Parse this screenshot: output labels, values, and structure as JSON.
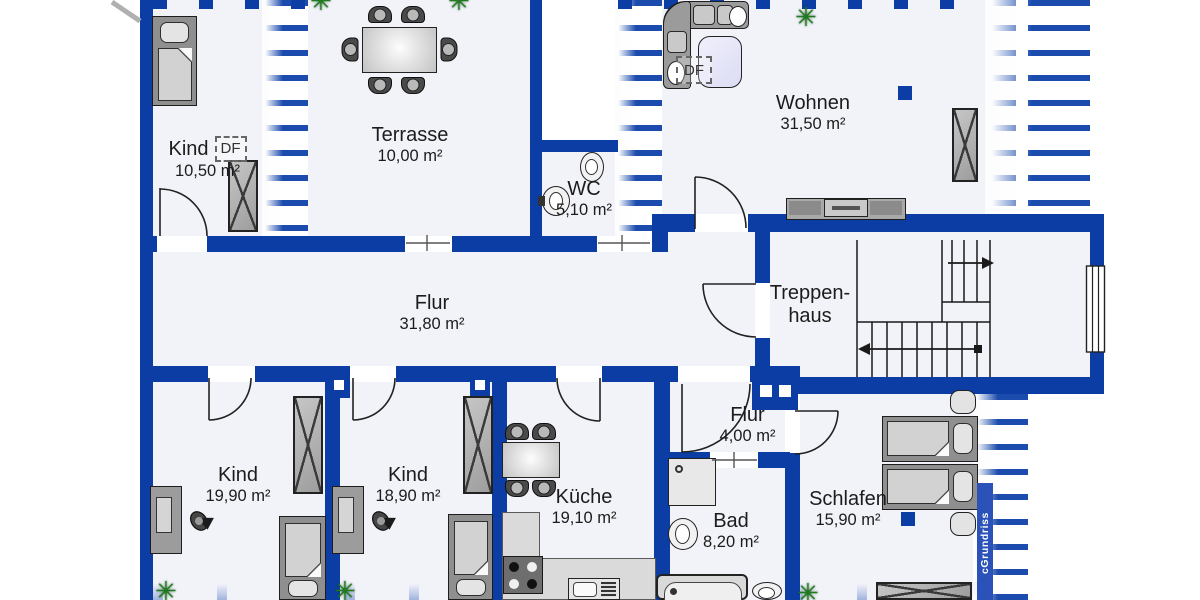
{
  "colors": {
    "wall": "#0c3da5",
    "hatch": "#1b4bad",
    "floor": "#f1f3f8",
    "green": "#1e7a1e",
    "rug": "#dcdcf4",
    "wmbg": "#2a52b8"
  },
  "rooms": [
    {
      "id": "kind-og",
      "name": "Kind",
      "area": "10,50 m²"
    },
    {
      "id": "terrasse",
      "name": "Terrasse",
      "area": "10,00 m²"
    },
    {
      "id": "wc",
      "name": "WC",
      "area": "5,10 m²"
    },
    {
      "id": "wohnen",
      "name": "Wohnen",
      "area": "31,50 m²"
    },
    {
      "id": "flur",
      "name": "Flur",
      "area": "31,80 m²"
    },
    {
      "id": "treppenhaus",
      "name_line1": "Treppen-",
      "name_line2": "haus"
    },
    {
      "id": "kind-links",
      "name": "Kind",
      "area": "19,90 m²"
    },
    {
      "id": "kind-mitte",
      "name": "Kind",
      "area": "18,90 m²"
    },
    {
      "id": "kueche",
      "name": "Küche",
      "area": "19,10 m²"
    },
    {
      "id": "flur-klein",
      "name": "Flur",
      "area": "4,00 m²"
    },
    {
      "id": "bad",
      "name": "Bad",
      "area": "8,20 m²"
    },
    {
      "id": "schlafen",
      "name": "Schlafen",
      "area": "15,90 m²"
    }
  ],
  "annotations": {
    "df_kind": "DF",
    "df_wohnen": "DF"
  },
  "watermark": "cGrundriss"
}
